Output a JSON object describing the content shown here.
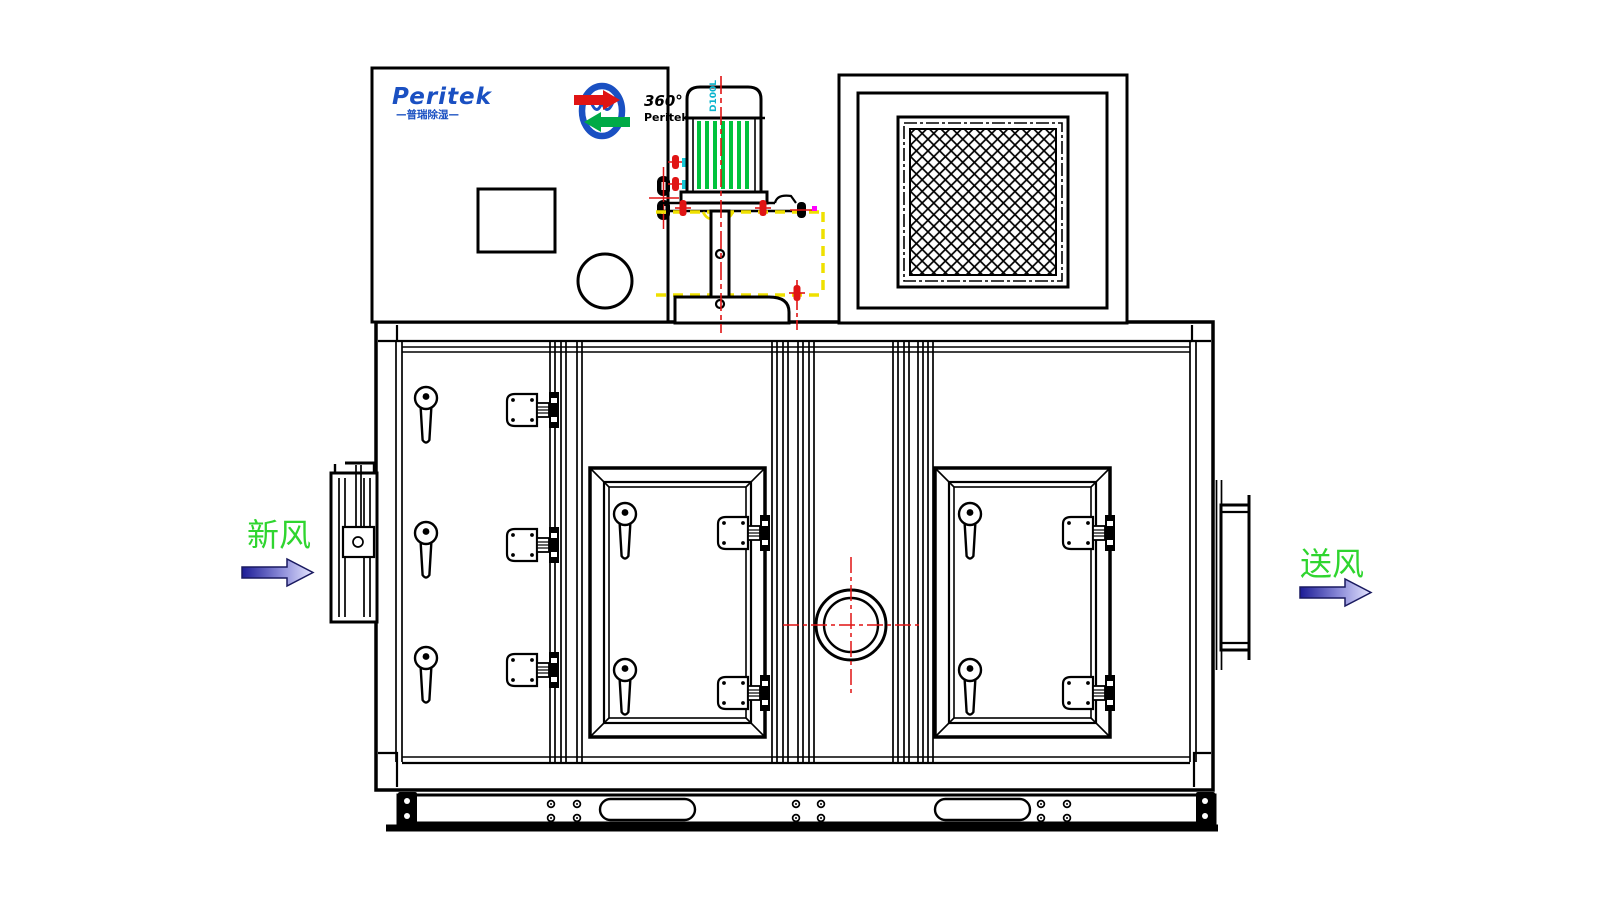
{
  "drawing": {
    "background": "#ffffff",
    "line_color": "#000000",
    "centerline_color": "#e01414",
    "hidden_outline_color": "#efe000"
  },
  "brand": {
    "logo_text": "Peritek",
    "logo_subtext": "—普瑞除湿—",
    "logo_color": "#1a50c2",
    "wheel_logo": {
      "degree_text": "360°",
      "name_text": "Peritek",
      "text_color": "#000000",
      "ring_color": "#1a50c2",
      "top_arrow_color": "#e01414",
      "bottom_arrow_color": "#00aa46"
    }
  },
  "motor": {
    "model_label": "D100L",
    "model_label_color": "#0ab4cd",
    "fin_color": "#00c33c"
  },
  "flow_labels": {
    "fresh_air": {
      "text": "新风",
      "color": "#2fd52f",
      "arrow_direction": "right"
    },
    "supply_air": {
      "text": "送风",
      "color": "#2fd52f",
      "arrow_direction": "right"
    },
    "arrow_gradient_start": "#1c1c96",
    "arrow_gradient_end": "#e6e6ff",
    "arrow_outline": "#1a1a60"
  },
  "accents": {
    "cyan_fitting": "#19c8d7",
    "magenta_mark": "#ff00ff",
    "sight_glass_crosshair": "#e01414"
  }
}
